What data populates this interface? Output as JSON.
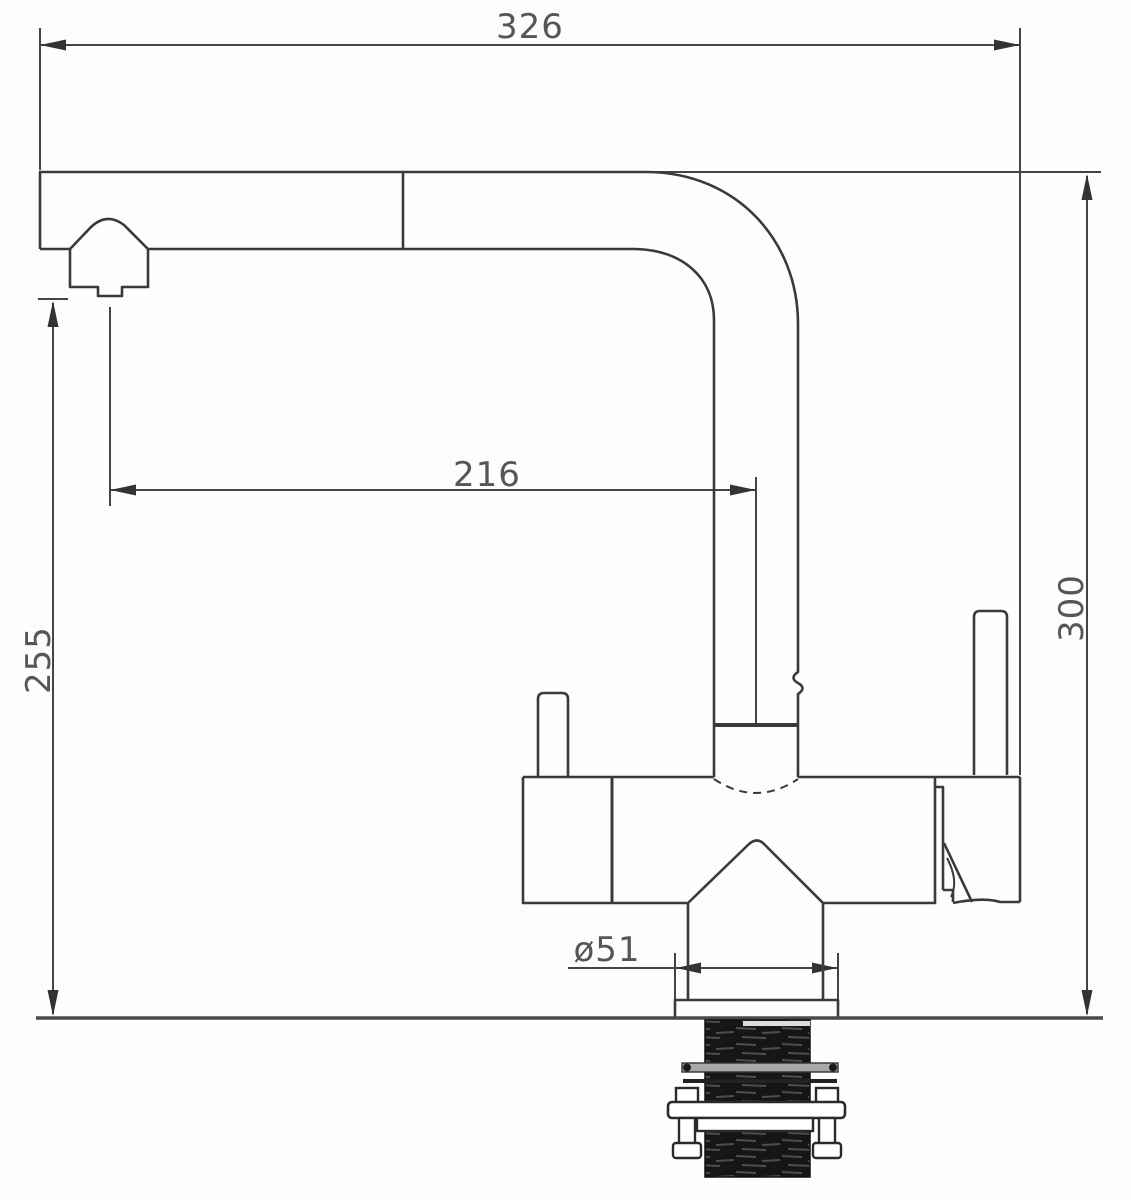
{
  "page": {
    "background": "#fdfdfd",
    "line_color": "#3a3a3a",
    "dim_line_color": "#444444",
    "text_color": "#565656",
    "shank_color": "#161616"
  },
  "drawing": {
    "type": "technical-dimension-drawing",
    "subject": "kitchen mixer faucet with pull-out spray, side elevation",
    "units": "mm",
    "dimensions": {
      "overall_width": "326",
      "spout_reach": "216",
      "outlet_height": "255",
      "overall_height": "300",
      "base_diameter": "ø51"
    },
    "parts": [
      "spout",
      "pull-out-spray-head",
      "riser-pipe",
      "mixer-body",
      "left-lever",
      "right-lever",
      "base-escutcheon",
      "countertop",
      "threaded-shank",
      "mounting-bracket",
      "mounting-bolts"
    ]
  }
}
